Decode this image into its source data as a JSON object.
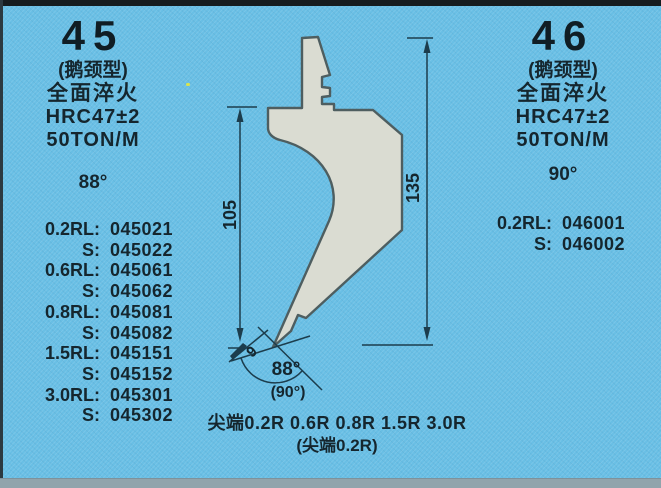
{
  "left_panel": {
    "number": "45",
    "type_label": "(鹅颈型)",
    "quench_label": "全面淬火",
    "hardness": "HRC47±2",
    "tonnage": "50TON/M",
    "angle": "88°",
    "rows": [
      {
        "label": "0.2RL:",
        "code": "045021"
      },
      {
        "label": "S:",
        "code": "045022"
      },
      {
        "label": "0.6RL:",
        "code": "045061"
      },
      {
        "label": "S:",
        "code": "045062"
      },
      {
        "label": "0.8RL:",
        "code": "045081"
      },
      {
        "label": "S:",
        "code": "045082"
      },
      {
        "label": "1.5RL:",
        "code": "045151"
      },
      {
        "label": "S:",
        "code": "045152"
      },
      {
        "label": "3.0RL:",
        "code": "045301"
      },
      {
        "label": "S:",
        "code": "045302"
      }
    ]
  },
  "right_panel": {
    "number": "46",
    "type_label": "(鹅颈型)",
    "quench_label": "全面淬火",
    "hardness": "HRC47±2",
    "tonnage": "50TON/M",
    "angle": "90°",
    "rows": [
      {
        "label": "0.2RL:",
        "code": "046001"
      },
      {
        "label": "S:",
        "code": "046002"
      }
    ]
  },
  "diagram": {
    "dim_height_left": "105",
    "dim_height_right": "135",
    "tip_width": "9",
    "tip_angle": "88°",
    "tip_angle_alt": "(90°)",
    "caption_line1": "尖端0.2R 0.6R 0.8R 1.5R 3.0R",
    "caption_line2": "(尖端0.2R)"
  },
  "colors": {
    "background": "#69bfe5",
    "ink": "#15262e",
    "punch_fill": "#dadcd2",
    "punch_outline": "#4e5e60",
    "dimension_line": "#1c3d4d",
    "scan_edge_top": "#161c1f",
    "bottom_strip": "#91a4ac"
  }
}
